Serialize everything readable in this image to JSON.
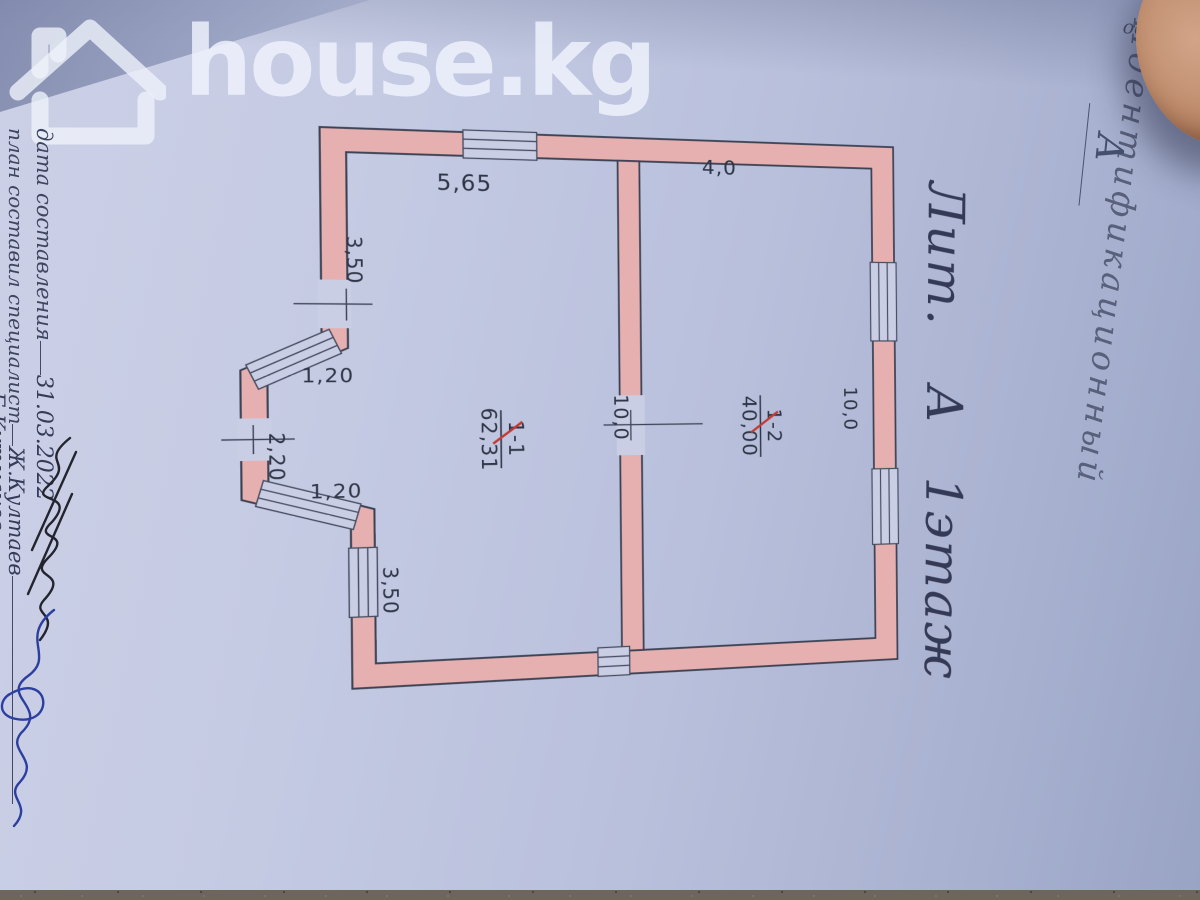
{
  "watermark": {
    "brand_text": "house.kg"
  },
  "corner_note": {
    "fragment": "оом"
  },
  "stamp_right": {
    "label": "Идентификационный",
    "handwritten_letter": "А"
  },
  "margin_left": {
    "date_label": "дата составления",
    "date_value": "31.03.2022",
    "specialist_label": "план составил специалист",
    "specialist_name": "Ж.Култаев",
    "approver_name": "Б.Кутманов"
  },
  "annotation_right": {
    "litera": "Лит.",
    "building": "А",
    "floor": "1этаж"
  },
  "plan": {
    "rooms": [
      {
        "number": "1-1",
        "area": "62,31"
      },
      {
        "number": "1-2",
        "area": "40,00"
      }
    ],
    "dims": {
      "top": "5,65",
      "right_top": "4,0",
      "left_upper": "3,50",
      "bay_up": "1,20",
      "bay_left": "2,20",
      "bay_low": "1,20",
      "left_lower": "3,50",
      "depth_left": "10,0",
      "depth_right": "10,0"
    },
    "colors": {
      "wall": "#e6b0b0",
      "line": "#3a4052",
      "red": "#c23b32"
    }
  }
}
